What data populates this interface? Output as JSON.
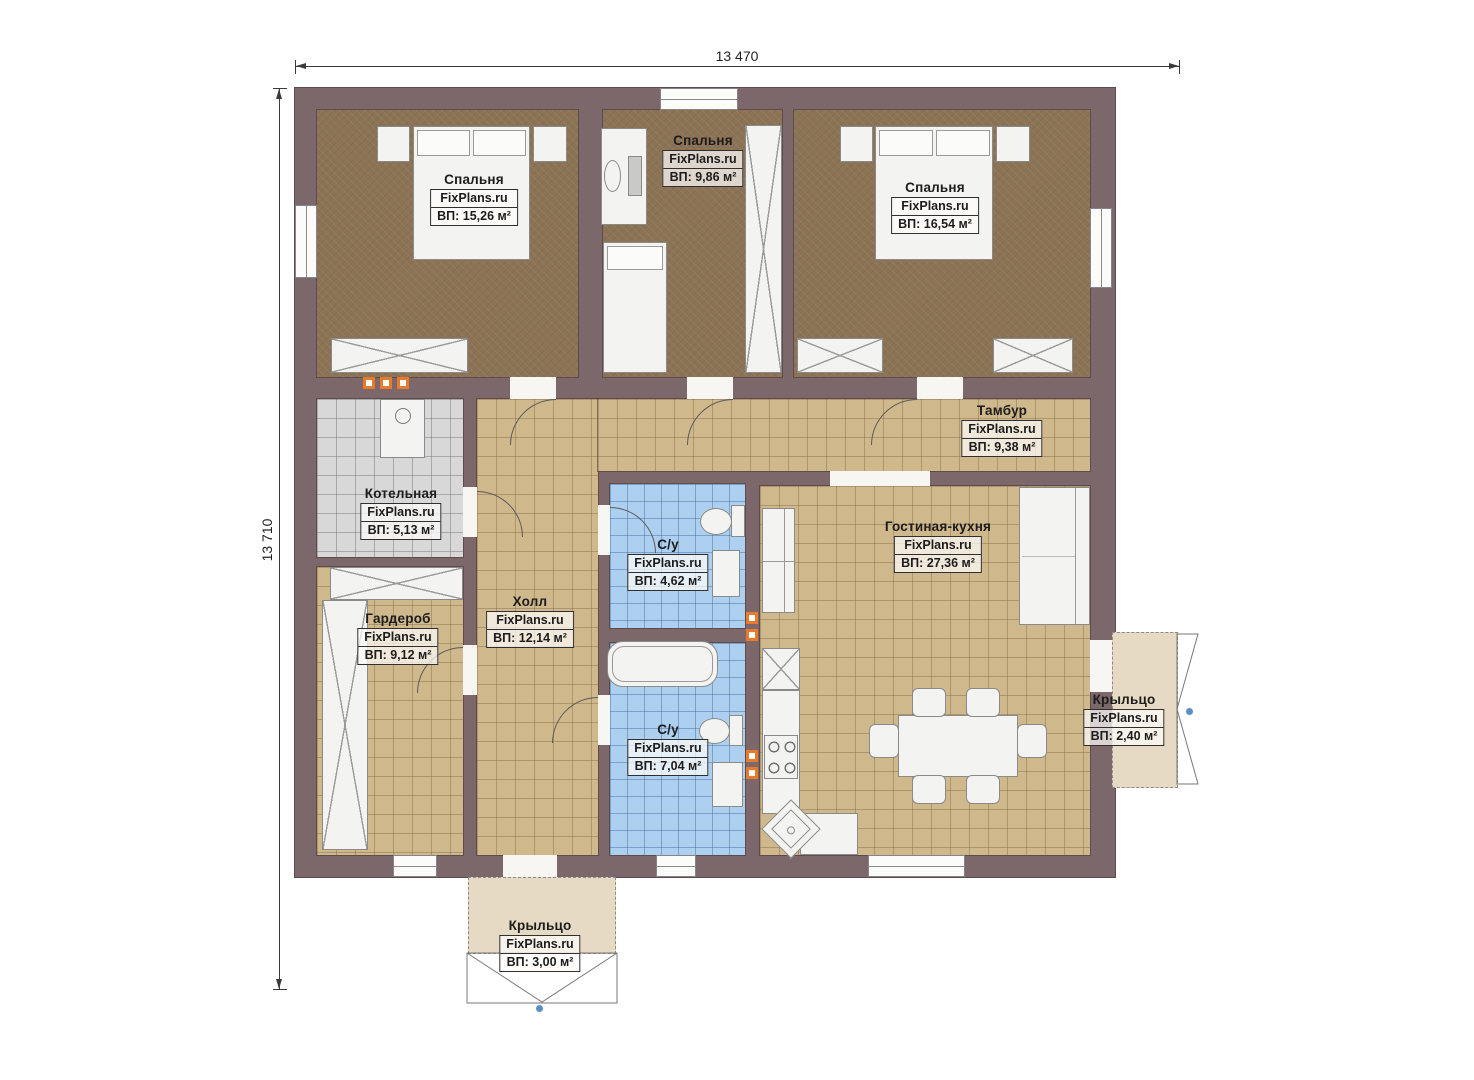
{
  "watermark": "FixPlans.ru",
  "dimensions": {
    "top": "13 470",
    "left": "13 710"
  },
  "rooms": {
    "bedroom1": {
      "name": "Спальня",
      "area": "ВП: 15,26 м²"
    },
    "bedroom2": {
      "name": "Спальня",
      "area": "ВП: 9,86 м²"
    },
    "bedroom3": {
      "name": "Спальня",
      "area": "ВП: 16,54 м²"
    },
    "tambour": {
      "name": "Тамбур",
      "area": "ВП: 9,38 м²"
    },
    "boiler": {
      "name": "Котельная",
      "area": "ВП: 5,13 м²"
    },
    "wardrobe": {
      "name": "Гардероб",
      "area": "ВП: 9,12 м²"
    },
    "hall": {
      "name": "Холл",
      "area": "ВП: 12,14 м²"
    },
    "bath_small": {
      "name": "С/у",
      "area": "ВП: 4,62 м²"
    },
    "bath_large": {
      "name": "С/у",
      "area": "ВП: 7,04 м²"
    },
    "living_kitchen": {
      "name": "Гостиная-кухня",
      "area": "ВП: 27,36 м²"
    },
    "porch_right": {
      "name": "Крыльцо",
      "area": "ВП: 2,40 м²"
    },
    "porch_bottom": {
      "name": "Крыльцо",
      "area": "ВП: 3,00 м²"
    }
  },
  "colors": {
    "wall": "#7c686a",
    "bedroom_floor": "#8c7356",
    "tile_floor": "#cfb88c",
    "bath_floor": "#aed0f0",
    "boiler_floor": "#d8d8d8",
    "porch_floor": "#e6dac4",
    "marker_orange": "#e87a2c",
    "marker_blue": "#5b8fc7"
  }
}
